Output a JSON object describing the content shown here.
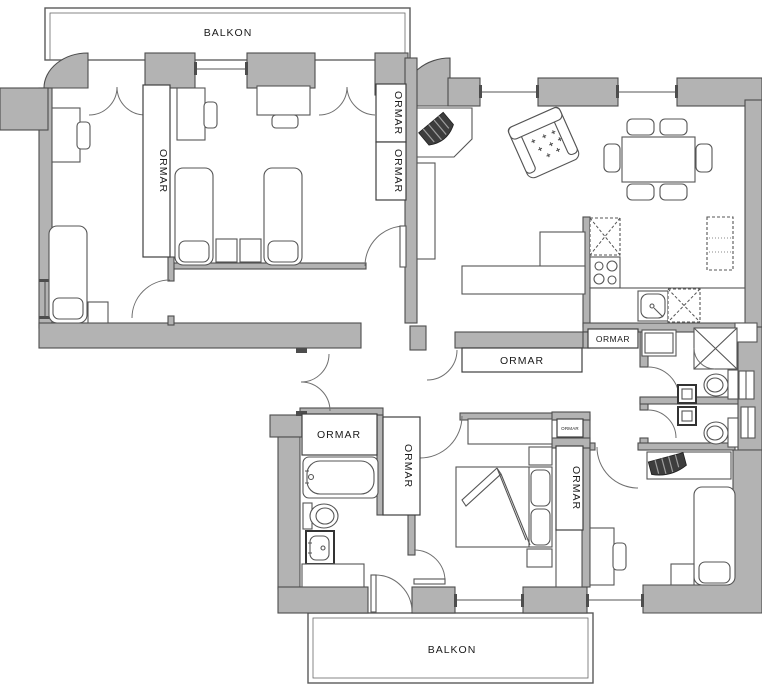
{
  "plan_title": "apartment-floor-plan",
  "colors": {
    "wall": "#b3b3b3",
    "outline": "#4d4d4d",
    "furniture_stroke": "#555555",
    "tv": "#3d3d3d",
    "background": "#ffffff"
  },
  "labels": [
    {
      "id": "balcony-top",
      "text": "BALKON",
      "orientation": "horizontal"
    },
    {
      "id": "wardrobe-room-a",
      "text": "ORMAR",
      "orientation": "vertical"
    },
    {
      "id": "wardrobe-room-b-1",
      "text": "ORMAR",
      "orientation": "vertical"
    },
    {
      "id": "wardrobe-room-b-2",
      "text": "ORMAR",
      "orientation": "vertical"
    },
    {
      "id": "wardrobe-kitchen",
      "text": "ORMAR",
      "orientation": "horizontal"
    },
    {
      "id": "wardrobe-hallway",
      "text": "ORMAR",
      "orientation": "horizontal"
    },
    {
      "id": "wardrobe-bathroom",
      "text": "ORMAR",
      "orientation": "horizontal"
    },
    {
      "id": "wardrobe-vestibule",
      "text": "ORMAR",
      "orientation": "vertical"
    },
    {
      "id": "wardrobe-master-small",
      "text": "ORMAR",
      "orientation": "horizontal"
    },
    {
      "id": "wardrobe-master",
      "text": "ORMAR",
      "orientation": "vertical"
    },
    {
      "id": "balcony-bottom",
      "text": "BALKON",
      "orientation": "horizontal"
    }
  ],
  "rooms": [
    {
      "name": "balcony-top",
      "furniture": []
    },
    {
      "name": "bedroom-left",
      "furniture": [
        "desk",
        "chair",
        "single-bed",
        "nightstand",
        "wardrobe"
      ]
    },
    {
      "name": "bedroom-middle",
      "furniture": [
        "desk",
        "chair",
        "desk",
        "chair",
        "single-bed",
        "single-bed",
        "nightstand",
        "nightstand",
        "wardrobe",
        "wardrobe"
      ]
    },
    {
      "name": "living-dining-kitchen",
      "furniture": [
        "corner-tv-cabinet",
        "tv",
        "shelf",
        "armchair",
        "corner-sofa",
        "dining-table",
        "dining-chairs-x6",
        "upper-cabinet",
        "stove",
        "kitchen-sink",
        "kitchen-counter",
        "fridge",
        "cabinet"
      ]
    },
    {
      "name": "hallway",
      "furniture": [
        "wardrobe-closet"
      ]
    },
    {
      "name": "bathroom-top",
      "furniture": [
        "washing-machine",
        "shower",
        "toilet",
        "sink",
        "radiator"
      ]
    },
    {
      "name": "bathroom-bottom",
      "furniture": [
        "toilet",
        "sink",
        "radiator"
      ]
    },
    {
      "name": "bathroom-main",
      "furniture": [
        "wardrobe",
        "bathtub",
        "toilet",
        "sink",
        "counter",
        "wardrobe"
      ]
    },
    {
      "name": "bedroom-master",
      "furniture": [
        "shelf",
        "double-bed",
        "nightstand",
        "nightstand",
        "wardrobe-small",
        "wardrobe",
        "dresser"
      ]
    },
    {
      "name": "bedroom-right",
      "furniture": [
        "tv-shelf",
        "tv",
        "single-bed",
        "nightstand",
        "desk",
        "chair"
      ]
    },
    {
      "name": "balcony-bottom",
      "furniture": []
    }
  ]
}
